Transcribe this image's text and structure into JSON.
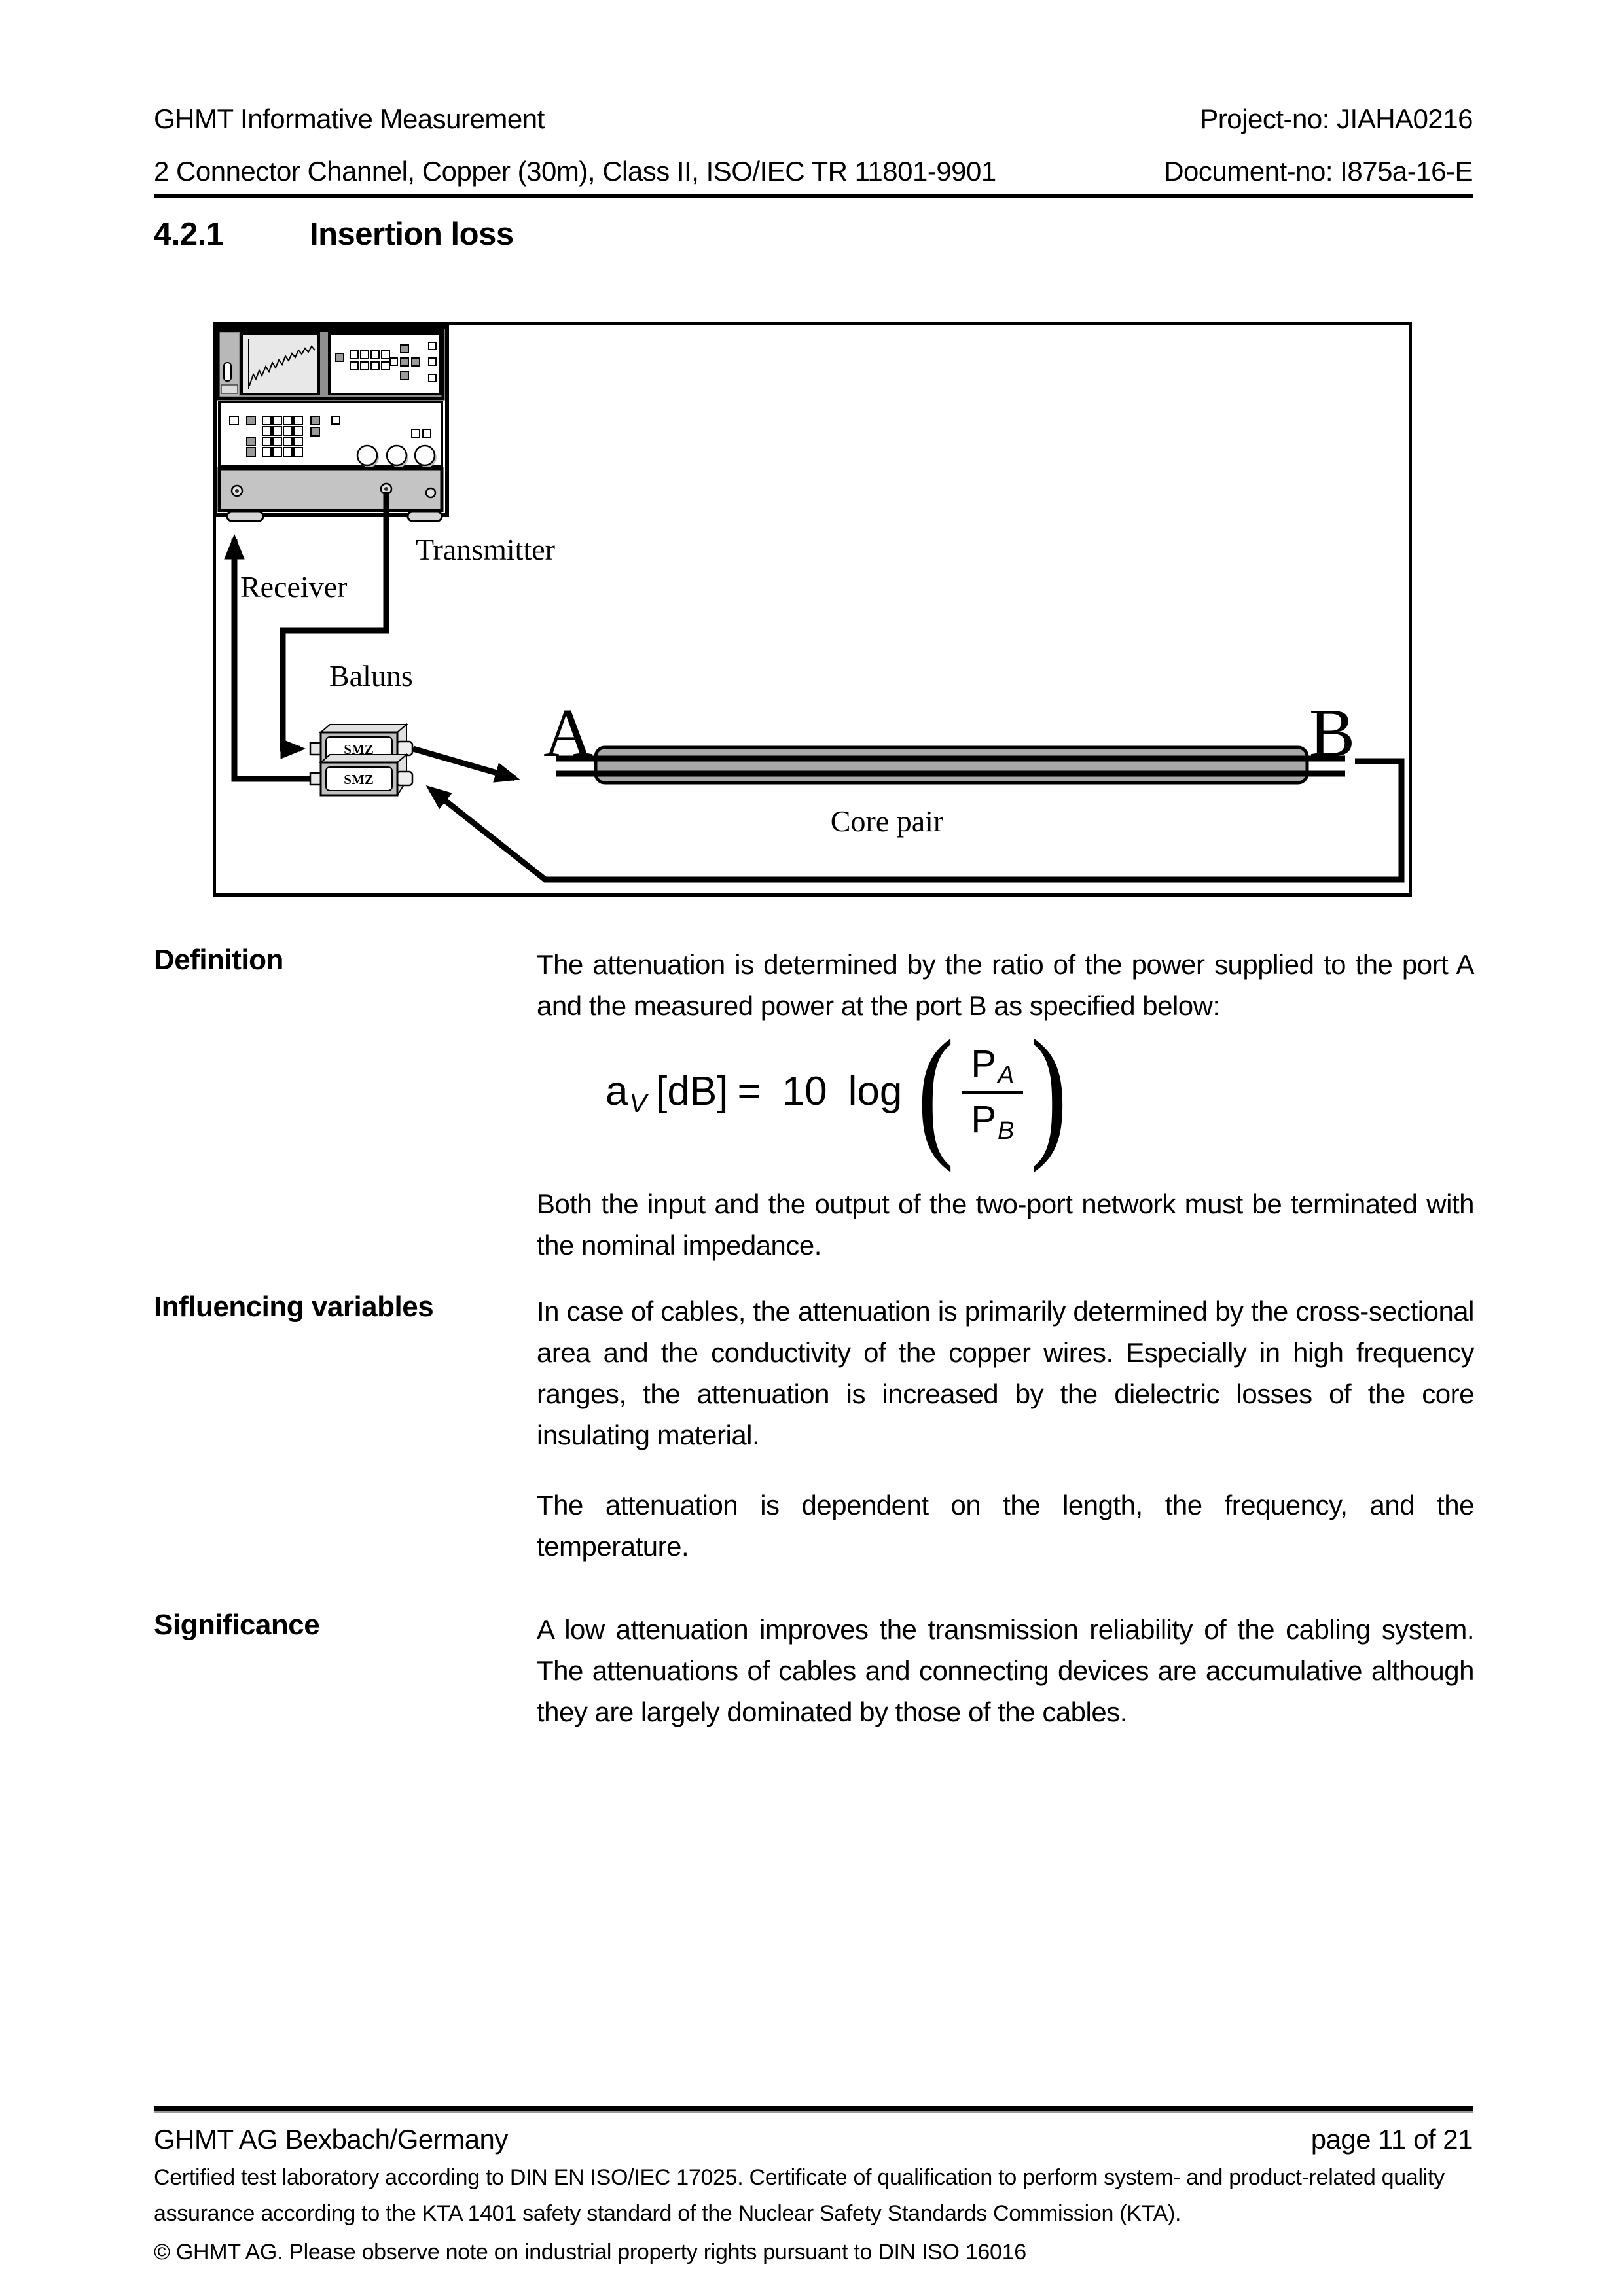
{
  "header": {
    "left_line1": "GHMT Informative Measurement",
    "left_line2": "2 Connector Channel, Copper (30m), Class II, ISO/IEC TR 11801-9901",
    "right_line1": "Project-no: JIAHA0216",
    "right_line2": "Document-no: I875a-16-E"
  },
  "section": {
    "number": "4.2.1",
    "title": "Insertion loss"
  },
  "diagram": {
    "labels": {
      "transmitter": "Transmitter",
      "receiver": "Receiver",
      "baluns": "Baluns",
      "balun1": "SMZ",
      "balun2": "SMZ",
      "port_a": "A",
      "port_b": "B",
      "core_pair": "Core pair"
    }
  },
  "definition": {
    "label": "Definition",
    "text": "The attenuation is determined by the ratio of the power supplied to the port A and the measured power at the port B as specified below:",
    "note": "Both the input and the output of the two-port network must be terminated with the nominal impedance."
  },
  "formula": {
    "lhs_base": "a",
    "lhs_sub": "V",
    "lhs_bracket": "[dB]",
    "equals": "=",
    "coefficient": "10",
    "operator": "log",
    "num_base": "P",
    "num_sub": "A",
    "den_base": "P",
    "den_sub": "B",
    "paren_open": "(",
    "paren_close": ")"
  },
  "influencing": {
    "label": "Influencing variables",
    "text1": "In case of cables, the attenuation is primarily determined by the cross-sectional area and the conductivity of the copper wires. Especially in high frequency ranges, the attenuation is increased by the dielectric losses of the core insulating material.",
    "text2": "The attenuation is dependent on the length, the frequency, and the temperature."
  },
  "significance": {
    "label": "Significance",
    "text": "A low attenuation improves the transmission reliability of the cabling system. The attenuations of cables and connecting devices are accumulative although they are largely dominated by those of the cables."
  },
  "footer": {
    "company": "GHMT AG Bexbach/Germany",
    "page_info": "page 11 of 21",
    "cert_text": "Certified test laboratory according to DIN EN ISO/IEC 17025. Certificate of qualification to perform system- and product-related quality assurance according to the KTA 1401 safety standard of the Nuclear Safety Standards Commission (KTA).",
    "copyright": "© GHMT AG. Please observe note on industrial property rights pursuant to DIN ISO 16016"
  }
}
